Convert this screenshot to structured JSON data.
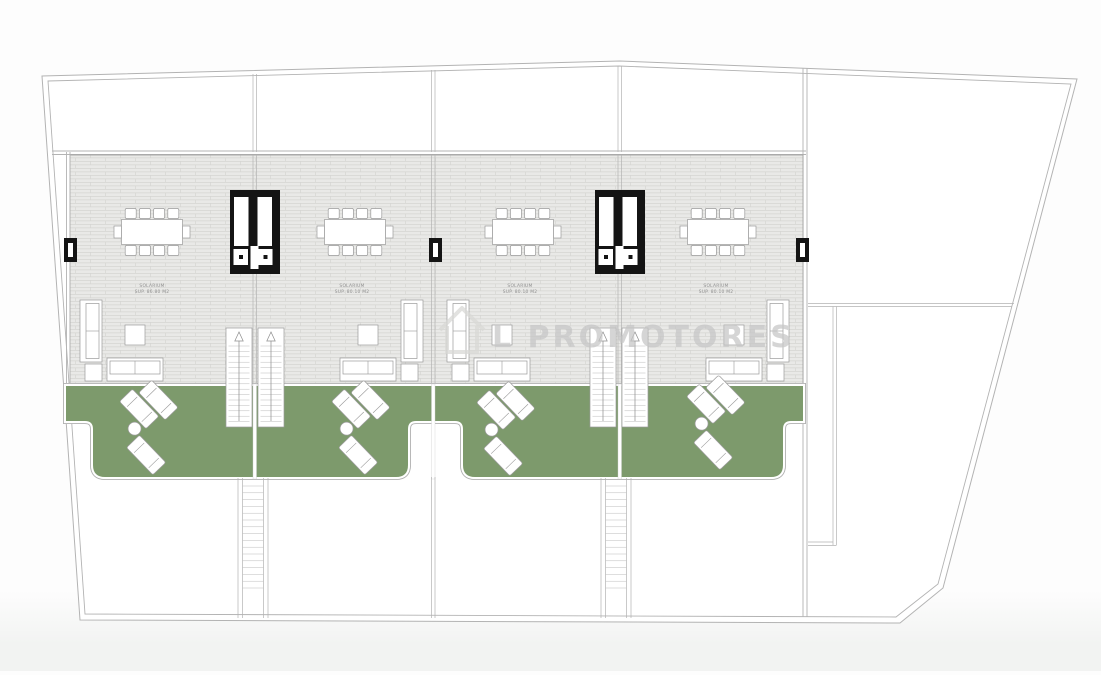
{
  "watermark": {
    "text": "L PROMOTORES",
    "icon": "house-logo-icon"
  },
  "units": [
    {
      "room_label": "SOLARIUM",
      "area_label": "SUP. 86.80 M2"
    },
    {
      "room_label": "SOLARIUM",
      "area_label": "SUP. 80.10 M2"
    },
    {
      "room_label": "SOLARIUM",
      "area_label": "SUP. 80.10 M2"
    },
    {
      "room_label": "SOLARIUM",
      "area_label": "SUP. 80.10 M2"
    }
  ],
  "colors": {
    "terrace_green": "#7d9a6c",
    "tile_fill": "#e9e9e7",
    "tile_line": "#d5d5d2",
    "wall_line": "#b3b3b3",
    "furniture_line": "#9a9a9a",
    "black_element": "#141414",
    "label_text": "#909090",
    "watermark_gray": "#c6c6c6",
    "page_bottom": "#f2f3f2"
  }
}
